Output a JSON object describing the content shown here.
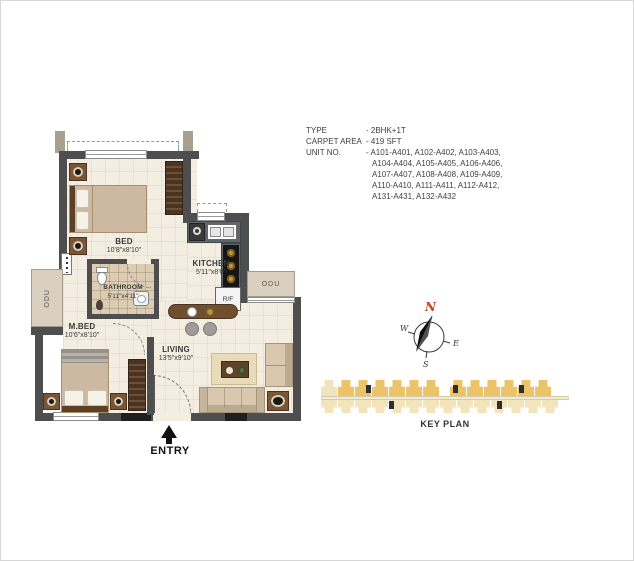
{
  "info": {
    "type_label": "TYPE",
    "type_value": "- 2BHK+1T",
    "carpet_label": "CARPET AREA",
    "carpet_value": "- 419 SFT",
    "unit_label": "UNIT NO.",
    "unit_lines": [
      "- A101-A401, A102-A402, A103-A403,",
      "A104-A404, A105-A405, A106-A406,",
      "A107-A407, A108-A408, A109-A409,",
      "A110-A410, A111-A411, A112-A412,",
      "A131-A431, A132-A432"
    ]
  },
  "rooms": {
    "bed": {
      "name": "BED",
      "dim": "10'8\"x8'10\""
    },
    "kitchen": {
      "name": "KITCHEN",
      "dim": "5'11\"x8'0\""
    },
    "bathroom": {
      "name": "BATHROOM",
      "dim": "5'11\"x4'11\""
    },
    "master_bed": {
      "name": "M.BED",
      "dim": "10'6\"x8'10\""
    },
    "living": {
      "name": "LIVING",
      "dim": "13'5\"x9'10\""
    }
  },
  "labels": {
    "odu_left": "ODU",
    "odu_right": "ODU",
    "fridge": "R/F",
    "entry": "ENTRY"
  },
  "compass": {
    "north": "N",
    "east": "E",
    "south": "S",
    "west": "W"
  },
  "key_plan": {
    "label": "KEY PLAN",
    "top_group1": 7,
    "top_group2": 6,
    "bottom_units": 14
  },
  "colors": {
    "wall": "#4e4e4e",
    "floor": "#f4eee2",
    "keyplan_gold": "#ecc369",
    "keyplan_cream": "#f3e4bc",
    "compass_north": "#c8441f",
    "counter": "#5d656d",
    "wood_dark": "#4a3322",
    "wood": "#7a5634"
  }
}
